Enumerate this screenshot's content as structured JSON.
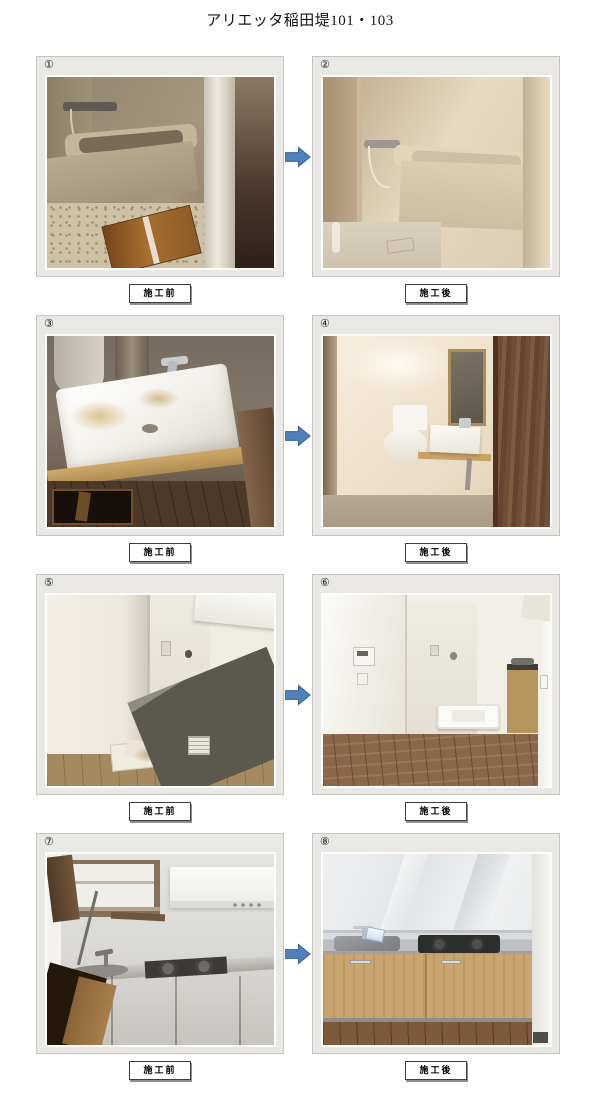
{
  "page": {
    "title": "アリエッタ稲田堤101・103"
  },
  "rows": [
    {
      "left": {
        "number": "①",
        "caption": "施工前"
      },
      "right": {
        "number": "②",
        "caption": "施工後"
      }
    },
    {
      "left": {
        "number": "③",
        "caption": "施工前"
      },
      "right": {
        "number": "④",
        "caption": "施工後"
      }
    },
    {
      "left": {
        "number": "⑤",
        "caption": "施工前"
      },
      "right": {
        "number": "⑥",
        "caption": "施工後"
      }
    },
    {
      "left": {
        "number": "⑦",
        "caption": "施工前"
      },
      "right": {
        "number": "⑧",
        "caption": "施工後"
      }
    }
  ],
  "icons": {
    "transform_arrow": "right-block-arrow"
  },
  "colors": {
    "arrow_fill": "#4f81bd",
    "arrow_stroke": "#38618f",
    "panel_bg": "#e9e8e5",
    "panel_border": "#c6c4c0",
    "page_bg": "#ffffff"
  }
}
